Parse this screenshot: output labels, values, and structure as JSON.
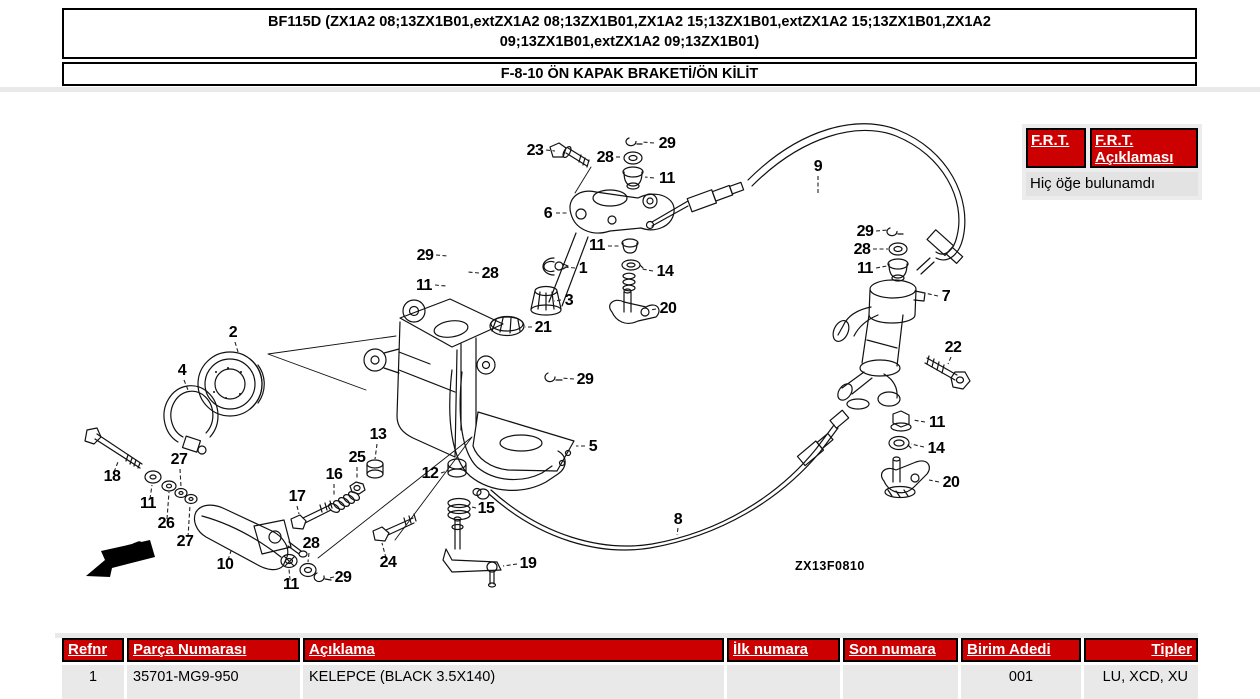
{
  "colors": {
    "header_red": "#cc0000",
    "panel_gray": "#ececec",
    "row_gray": "#e9e9e9",
    "line_black": "#111111"
  },
  "header": {
    "title_line1": "BF115D (ZX1A2 08;13ZX1B01,extZX1A2 08;13ZX1B01,ZX1A2 15;13ZX1B01,extZX1A2 15;13ZX1B01,ZX1A2",
    "title_line2": "09;13ZX1B01,extZX1A2 09;13ZX1B01)",
    "subtitle": "F-8-10 ÖN KAPAK BRAKETİ/ÖN KİLİT"
  },
  "frt": {
    "button1": "F.R.T.",
    "button2_line1": "F.R.T.",
    "button2_line2": "Açıklaması",
    "empty_message": "Hiç öğe bulunamdı"
  },
  "diagram": {
    "code": "ZX13F0810",
    "fr_label": "FR.",
    "labels": [
      {
        "t": "23",
        "x": 535,
        "y": 155,
        "lead": [
          546,
          150,
          555,
          151
        ]
      },
      {
        "t": "28",
        "x": 605,
        "y": 162,
        "lead": [
          616,
          157,
          622,
          157
        ]
      },
      {
        "t": "29",
        "x": 667,
        "y": 148,
        "lead": [
          654,
          143,
          642,
          142
        ]
      },
      {
        "t": "11",
        "x": 667,
        "y": 183,
        "lead": [
          654,
          178,
          645,
          177
        ]
      },
      {
        "t": "6",
        "x": 548,
        "y": 218,
        "lead": [
          556,
          213,
          568,
          213
        ]
      },
      {
        "t": "9",
        "x": 818,
        "y": 171,
        "lead": [
          818,
          176,
          818,
          193
        ]
      },
      {
        "t": "29",
        "x": 425,
        "y": 260,
        "lead": [
          436,
          255,
          448,
          256
        ]
      },
      {
        "t": "28",
        "x": 490,
        "y": 278,
        "lead": [
          479,
          273,
          468,
          272
        ]
      },
      {
        "t": "11",
        "x": 424,
        "y": 290,
        "lead": [
          435,
          285,
          446,
          286
        ]
      },
      {
        "t": "1",
        "x": 583,
        "y": 273,
        "lead": [
          575,
          268,
          564,
          267
        ]
      },
      {
        "t": "11",
        "x": 597,
        "y": 250,
        "lead": [
          608,
          246,
          619,
          246
        ]
      },
      {
        "t": "14",
        "x": 665,
        "y": 276,
        "lead": [
          653,
          271,
          642,
          269
        ]
      },
      {
        "t": "3",
        "x": 569,
        "y": 305,
        "lead": [
          561,
          300,
          554,
          301
        ]
      },
      {
        "t": "20",
        "x": 668,
        "y": 313,
        "lead": [
          656,
          309,
          650,
          310
        ]
      },
      {
        "t": "21",
        "x": 543,
        "y": 332,
        "lead": [
          532,
          327,
          525,
          327
        ]
      },
      {
        "t": "2",
        "x": 233,
        "y": 337,
        "lead": [
          235,
          342,
          238,
          352
        ]
      },
      {
        "t": "4",
        "x": 182,
        "y": 375,
        "lead": [
          184,
          380,
          188,
          390
        ]
      },
      {
        "t": "29",
        "x": 865,
        "y": 236,
        "lead": [
          876,
          231,
          888,
          230
        ]
      },
      {
        "t": "28",
        "x": 862,
        "y": 254,
        "lead": [
          873,
          249,
          888,
          249
        ]
      },
      {
        "t": "11",
        "x": 865,
        "y": 273,
        "lead": [
          876,
          268,
          887,
          266
        ]
      },
      {
        "t": "7",
        "x": 946,
        "y": 301,
        "lead": [
          938,
          296,
          920,
          292
        ]
      },
      {
        "t": "22",
        "x": 953,
        "y": 352,
        "lead": [
          951,
          357,
          948,
          364
        ]
      },
      {
        "t": "29",
        "x": 585,
        "y": 384,
        "lead": [
          574,
          379,
          561,
          378
        ]
      },
      {
        "t": "5",
        "x": 593,
        "y": 451,
        "lead": [
          585,
          446,
          576,
          446
        ]
      },
      {
        "t": "12",
        "x": 430,
        "y": 478,
        "lead": [
          441,
          473,
          447,
          471
        ]
      },
      {
        "t": "13",
        "x": 378,
        "y": 439,
        "lead": [
          377,
          444,
          375,
          459
        ]
      },
      {
        "t": "25",
        "x": 357,
        "y": 462,
        "lead": [
          357,
          467,
          357,
          480
        ]
      },
      {
        "t": "16",
        "x": 334,
        "y": 479,
        "lead": [
          334,
          484,
          334,
          497
        ]
      },
      {
        "t": "17",
        "x": 297,
        "y": 501,
        "lead": [
          297,
          506,
          299,
          514
        ]
      },
      {
        "t": "15",
        "x": 486,
        "y": 513,
        "lead": [
          476,
          508,
          472,
          507
        ]
      },
      {
        "t": "18",
        "x": 112,
        "y": 481,
        "lead": [
          114,
          472,
          118,
          462
        ]
      },
      {
        "t": "11",
        "x": 148,
        "y": 508,
        "lead": [
          150,
          499,
          152,
          485
        ]
      },
      {
        "t": "26",
        "x": 166,
        "y": 528,
        "lead": [
          167,
          519,
          169,
          492
        ]
      },
      {
        "t": "27",
        "x": 179,
        "y": 464,
        "lead": [
          180,
          469,
          181,
          487
        ]
      },
      {
        "t": "27",
        "x": 185,
        "y": 546,
        "lead": [
          188,
          537,
          190,
          505
        ]
      },
      {
        "t": "10",
        "x": 225,
        "y": 569,
        "lead": [
          228,
          560,
          232,
          548
        ]
      },
      {
        "t": "24",
        "x": 388,
        "y": 567,
        "lead": [
          386,
          558,
          382,
          543
        ]
      },
      {
        "t": "28",
        "x": 311,
        "y": 548,
        "lead": [
          309,
          553,
          308,
          562
        ]
      },
      {
        "t": "29",
        "x": 343,
        "y": 582,
        "lead": [
          334,
          577,
          329,
          578
        ]
      },
      {
        "t": "11",
        "x": 291,
        "y": 589,
        "lead": [
          290,
          580,
          289,
          569
        ]
      },
      {
        "t": "19",
        "x": 528,
        "y": 568,
        "lead": [
          517,
          564,
          503,
          566
        ]
      },
      {
        "t": "8",
        "x": 678,
        "y": 524,
        "lead": [
          678,
          528,
          677,
          535
        ]
      },
      {
        "t": "11",
        "x": 937,
        "y": 427,
        "lead": [
          925,
          422,
          913,
          420
        ]
      },
      {
        "t": "14",
        "x": 936,
        "y": 453,
        "lead": [
          924,
          447,
          911,
          444
        ]
      },
      {
        "t": "20",
        "x": 951,
        "y": 487,
        "lead": [
          939,
          482,
          929,
          480
        ]
      }
    ]
  },
  "table": {
    "headers": [
      "Refnr",
      "Parça Numarası",
      "Açıklama",
      "İlk numara",
      "Son numara",
      "Birim Adedi",
      "Tipler"
    ],
    "rows": [
      [
        "1",
        "35701-MG9-950",
        "KELEPCE (BLACK 3.5X140)",
        "",
        "",
        "001",
        "LU, XCD, XU"
      ]
    ]
  }
}
